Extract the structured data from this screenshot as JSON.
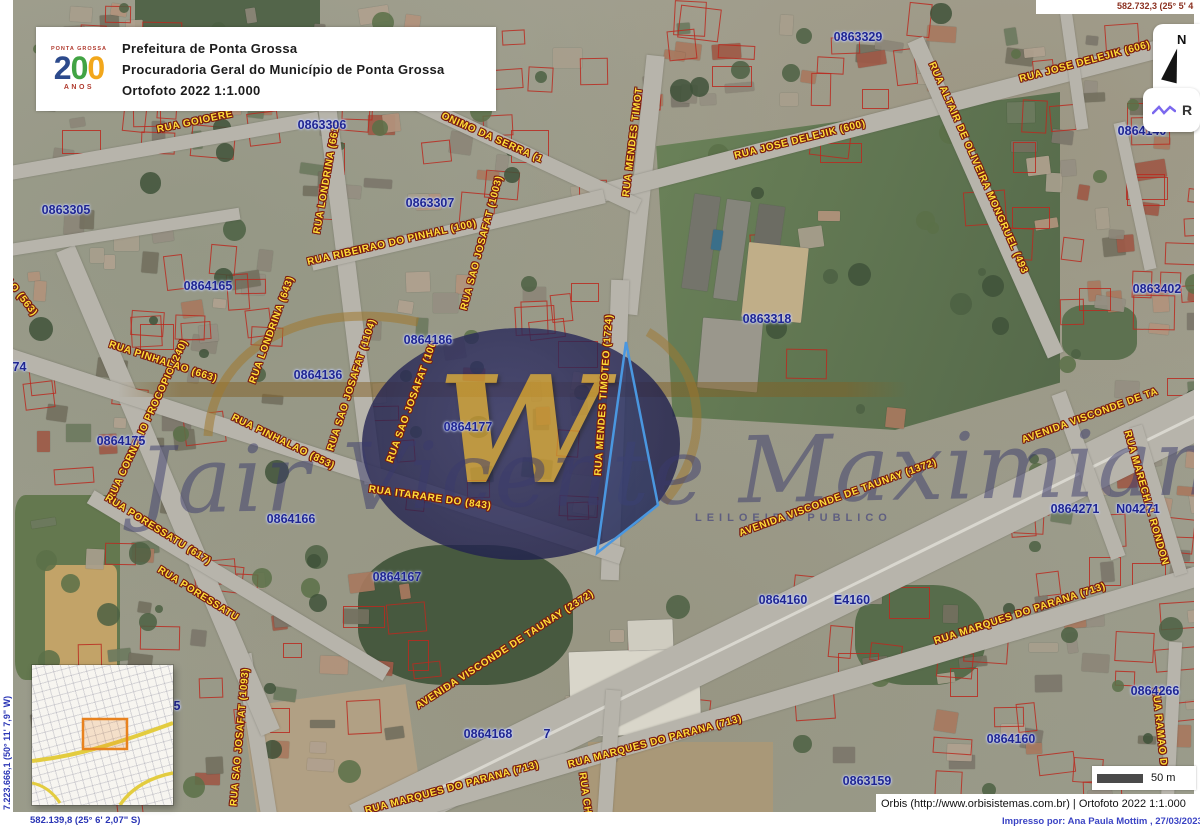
{
  "header": {
    "l1": "Prefeitura de Ponta Grossa",
    "l2": "Procuradoria Geral do Município de Ponta Grossa",
    "l3": "Ortofoto 2022 1:1.000",
    "logo": {
      "top": "PONTA GROSSA",
      "num2": "2",
      "numO1": "0",
      "numO2": "0",
      "anos": "ANOS"
    }
  },
  "coords": {
    "tr": "582.732,3 (25° 5' 4",
    "bl": "582.139,8 (25° 6' 2,07\" S)",
    "lv": "7.223.666,1 (50° 11' 7,9\" W)"
  },
  "compass": {
    "n": "N"
  },
  "layers": {
    "r": "R"
  },
  "scale": {
    "label": "50 m"
  },
  "attrib": {
    "src": "Orbis (http://www.orbisistemas.com.br) | Ortofoto 2022 1:1.000",
    "printed": "Impresso por: Ana Paula Mottim , 27/03/2023"
  },
  "watermark": {
    "w": "W",
    "name": "Jair Vicente Maximiano",
    "sub": "LEILOEIRO PUBLICO"
  },
  "colors": {
    "parcel_outline": "#ba2a20",
    "parcel_text": "#1f2590",
    "street_text": "#ffdf38",
    "highlight_parcel": "#4a97e0",
    "inset_highlight": "#e8821e"
  },
  "street_labels": [
    {
      "text": "RUA GOIOERE",
      "x": 195,
      "y": 122,
      "rot": -12
    },
    {
      "text": "RUA LONDRINA (661)",
      "x": 327,
      "y": 178,
      "rot": -80
    },
    {
      "text": "RUA RIBEIRAO DO PINHAL (100)",
      "x": 392,
      "y": 243,
      "rot": -13
    },
    {
      "text": "ONIMO DA SERRA (1",
      "x": 492,
      "y": 138,
      "rot": 24
    },
    {
      "text": "RUA JOSE DELEJIK (600)",
      "x": 800,
      "y": 140,
      "rot": -14
    },
    {
      "text": "RUA JOSE DELEJIK (606)",
      "x": 1085,
      "y": 62,
      "rot": -15
    },
    {
      "text": "RUA ALTAIR DE OLIVEIRA MONGRUEL (493",
      "x": 978,
      "y": 168,
      "rot": 66
    },
    {
      "text": "RUA MENDES TIMOT",
      "x": 633,
      "y": 142,
      "rot": -83
    },
    {
      "text": "RUA MENDES TIMOTEO (1724)",
      "x": 604,
      "y": 395,
      "rot": -86
    },
    {
      "text": "RUA SAO JOSAFAT (1003)",
      "x": 482,
      "y": 243,
      "rot": -75
    },
    {
      "text": "RUA SAO JOSAFAT (1104)",
      "x": 352,
      "y": 385,
      "rot": -72
    },
    {
      "text": "RUA SAO JOSAFAT (100",
      "x": 412,
      "y": 402,
      "rot": -70
    },
    {
      "text": "RUA LONDRINA (643)",
      "x": 272,
      "y": 330,
      "rot": -70
    },
    {
      "text": "RUA CORNELIO PROCOPIO (240)",
      "x": 148,
      "y": 420,
      "rot": -65
    },
    {
      "text": "HALAO (563)",
      "x": 14,
      "y": 288,
      "rot": 52
    },
    {
      "text": "RUA PINHALAO (663)",
      "x": 163,
      "y": 362,
      "rot": 18
    },
    {
      "text": "RUA PINHALAO (853)",
      "x": 283,
      "y": 442,
      "rot": 26
    },
    {
      "text": "RUA ITARARE DO (843)",
      "x": 430,
      "y": 498,
      "rot": 8
    },
    {
      "text": "RUA PORESSATU (617)",
      "x": 158,
      "y": 530,
      "rot": 32
    },
    {
      "text": "RUA PORESSATU",
      "x": 198,
      "y": 594,
      "rot": 32
    },
    {
      "text": "RUA SAO JOSAFAT (1093)",
      "x": 240,
      "y": 737,
      "rot": -85
    },
    {
      "text": "AVENIDA VISCONDE DE TAUNAY (2372)",
      "x": 505,
      "y": 650,
      "rot": -33
    },
    {
      "text": "AVENIDA VISCONDE DE TAUNAY (1372)",
      "x": 838,
      "y": 498,
      "rot": -20
    },
    {
      "text": "AVENIDA VISCONDE DE TA",
      "x": 1090,
      "y": 416,
      "rot": -20
    },
    {
      "text": "RUA MARECHAL RONDON",
      "x": 1146,
      "y": 498,
      "rot": 74
    },
    {
      "text": "RUA MARQUES DO PARANA (713)",
      "x": 1020,
      "y": 614,
      "rot": -18
    },
    {
      "text": "RUA MARQUES DO PARANA (713)",
      "x": 655,
      "y": 742,
      "rot": -15
    },
    {
      "text": "RUA MARQUES DO PARANA (713)",
      "x": 452,
      "y": 788,
      "rot": -15
    },
    {
      "text": "RUA CHI",
      "x": 585,
      "y": 795,
      "rot": 82
    },
    {
      "text": "RUA RAMAO DOU",
      "x": 1160,
      "y": 735,
      "rot": 84
    }
  ],
  "parcel_labels": [
    {
      "text": "0863329",
      "x": 858,
      "y": 37
    },
    {
      "text": "0863306",
      "x": 322,
      "y": 125
    },
    {
      "text": "0863305",
      "x": 66,
      "y": 210
    },
    {
      "text": "0863307",
      "x": 430,
      "y": 203
    },
    {
      "text": "0864165",
      "x": 208,
      "y": 286
    },
    {
      "text": "174",
      "x": 16,
      "y": 367
    },
    {
      "text": "0864186",
      "x": 428,
      "y": 340
    },
    {
      "text": "0864136",
      "x": 318,
      "y": 375
    },
    {
      "text": "0864177",
      "x": 468,
      "y": 427
    },
    {
      "text": "0864175",
      "x": 121,
      "y": 441
    },
    {
      "text": "0863318",
      "x": 767,
      "y": 319
    },
    {
      "text": "0864166",
      "x": 291,
      "y": 519
    },
    {
      "text": "0864167",
      "x": 397,
      "y": 577
    },
    {
      "text": "0864160",
      "x": 783,
      "y": 600
    },
    {
      "text": "E4160",
      "x": 852,
      "y": 600
    },
    {
      "text": "0864168",
      "x": 488,
      "y": 734
    },
    {
      "text": "7",
      "x": 547,
      "y": 734
    },
    {
      "text": "0864271",
      "x": 1075,
      "y": 509
    },
    {
      "text": "N04271",
      "x": 1138,
      "y": 509
    },
    {
      "text": "0863402",
      "x": 1157,
      "y": 289
    },
    {
      "text": "0864266",
      "x": 1155,
      "y": 691
    },
    {
      "text": "0864160",
      "x": 1011,
      "y": 739
    },
    {
      "text": "0863159",
      "x": 867,
      "y": 781
    },
    {
      "text": "0864140",
      "x": 1142,
      "y": 131
    },
    {
      "text": "5",
      "x": 177,
      "y": 706
    }
  ]
}
